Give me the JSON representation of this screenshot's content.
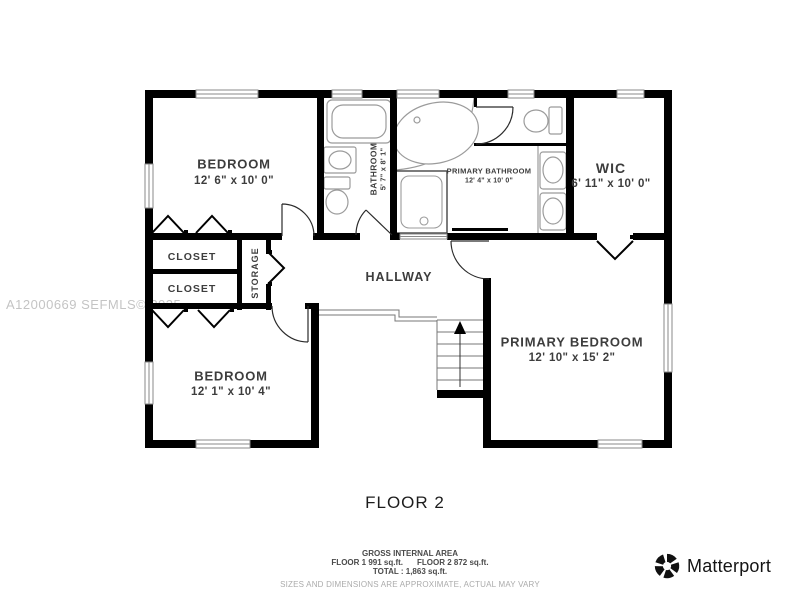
{
  "watermark": "A12000669 SEFMLS© 2025",
  "floor_label": "FLOOR 2",
  "rooms": {
    "bedroom_top": {
      "name": "BEDROOM",
      "dims": "12' 6\" x 10' 0\""
    },
    "bathroom": {
      "name": "BATHROOM",
      "dims": "5' 7\" x 8' 1\""
    },
    "primary_bathroom": {
      "name": "PRIMARY BATHROOM",
      "dims": "12' 4\" x 10' 0\""
    },
    "wic": {
      "name": "WIC",
      "dims": "6' 11\" x 10' 0\""
    },
    "closet_top": {
      "name": "CLOSET"
    },
    "closet_bottom": {
      "name": "CLOSET"
    },
    "storage": {
      "name": "STORAGE"
    },
    "hallway": {
      "name": "HALLWAY"
    },
    "bedroom_bottom": {
      "name": "BEDROOM",
      "dims": "12' 1\" x 10' 4\""
    },
    "primary_bedroom": {
      "name": "PRIMARY BEDROOM",
      "dims": "12' 10\" x 15' 2\""
    }
  },
  "footer": {
    "gross_title": "GROSS INTERNAL AREA",
    "floor1_area": "FLOOR 1 991 sq.ft.",
    "floor2_area": "FLOOR 2 872 sq.ft.",
    "total_line": "TOTAL :  1,863 sq.ft.",
    "disclaimer": "SIZES AND DIMENSIONS ARE APPROXIMATE, ACTUAL MAY VARY"
  },
  "brand": {
    "logo_text": "Matterport"
  },
  "colors": {
    "wall": "#000000",
    "fixture": "#9b9b9b",
    "label": "#3d3d3d",
    "watermark": "#c4c4c4"
  }
}
